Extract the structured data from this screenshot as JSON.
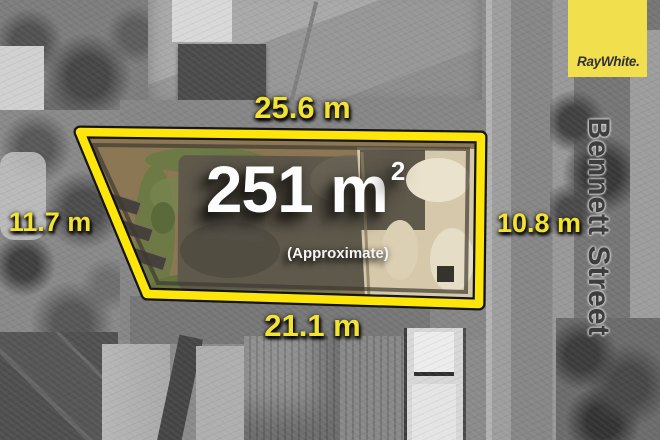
{
  "listing": {
    "area_value": "251 m",
    "area_superscript": "2",
    "area_qualifier": "(Approximate)",
    "measurements": {
      "top": "25.6 m",
      "left": "11.7 m",
      "right": "10.8 m",
      "bottom": "21.1 m"
    },
    "street_name": "Bennett Street"
  },
  "branding": {
    "agency_logo_text": "RayWhite."
  },
  "colors": {
    "boundary_yellow": "#ffe60a",
    "measurement_text_yellow": "#f2e233",
    "logo_background_yellow": "#f1df4e",
    "logo_text": "#31313d",
    "area_text": "#fdfdfd",
    "street_text": "#3d3d3d"
  }
}
